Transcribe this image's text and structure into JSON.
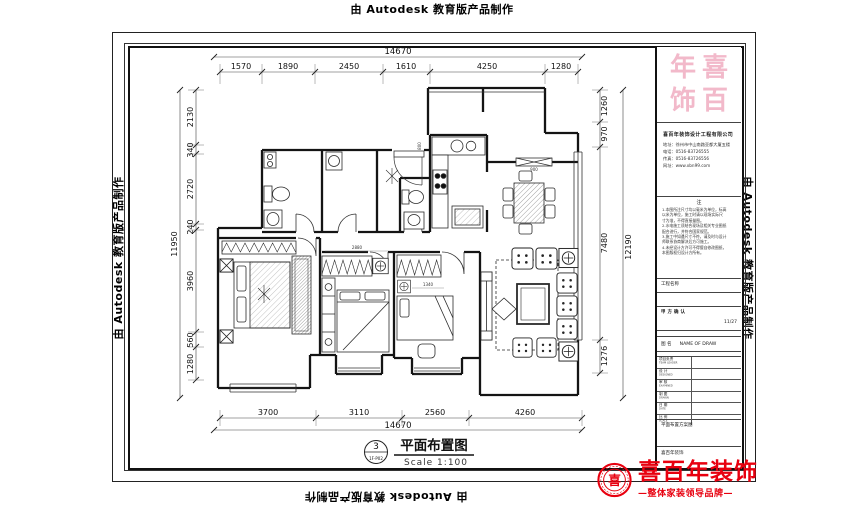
{
  "watermark": {
    "text": "由 Autodesk 教育版产品制作"
  },
  "dimensions": {
    "top": {
      "total": "14670",
      "segments": [
        "1570",
        "1890",
        "2450",
        "1610",
        "4250",
        "1280"
      ]
    },
    "bottom": {
      "total": "14670",
      "segments": [
        "3700",
        "3110",
        "2560",
        "4260"
      ]
    },
    "left": {
      "total": "11950",
      "segments": [
        "2130",
        "340",
        "2720",
        "240",
        "3960",
        "560",
        "1280"
      ]
    },
    "right": {
      "total": "12190",
      "segments": [
        "1260",
        "970",
        "7480",
        "1276"
      ]
    },
    "interior": {
      "bed2": "2880",
      "bed3": "1340",
      "dining": "900",
      "kitchen": "800"
    }
  },
  "caption": {
    "number": "3",
    "sheet_code": "1F-P02",
    "title": "平面布置图",
    "scale": "Scale 1:100"
  },
  "title_block": {
    "seal_chars": [
      "年",
      "喜",
      "饰",
      "百"
    ],
    "company": "喜百年装饰设计工程有限公司",
    "contact_lines": [
      "地址：徐州市中山南路亚都大厦五楼",
      "电话：0516-83726555",
      "传真：0516-83726556",
      "网址：www.xbn99.com"
    ],
    "notes_title": "注",
    "notes": [
      "1.本图所注尺寸均以毫米为单位，标高",
      "  以米为单位，施工时请以现场实际尺",
      "  寸为准，不得直接量图。",
      "2.水电施工须结合现场及相关专业图纸",
      "  配合进行，并符合国家规范。",
      "3.施工中如遇尺寸不符，请及时与设计",
      "  师联系协商解决后方可施工。",
      "4.未经设计方许可不得擅自修改图纸，",
      "  本图版权归设计方所有。"
    ],
    "project_label": "工程名称",
    "client_label": "甲方确认",
    "client_date": "11/27",
    "drawing_label_cn": "图 名",
    "drawing_label_en": "NAME OF DRAW",
    "rows": [
      {
        "cn": "项目负责",
        "en": "TEAM LEADER"
      },
      {
        "cn": "设 计",
        "en": "DESIGNED"
      },
      {
        "cn": "审 核",
        "en": "EXAMINED"
      },
      {
        "cn": "制 图",
        "en": "DRAWN"
      },
      {
        "cn": "日 期",
        "en": "DATE"
      },
      {
        "cn": "比 例",
        "en": "SCALE"
      }
    ],
    "footer_note": "平面布置方案图",
    "footer_brand": "喜百年装饰"
  },
  "brand": {
    "name": "喜百年装饰",
    "tagline": "—整体家装领导品牌—",
    "seal_char": "喜",
    "color": "#e8000f"
  }
}
